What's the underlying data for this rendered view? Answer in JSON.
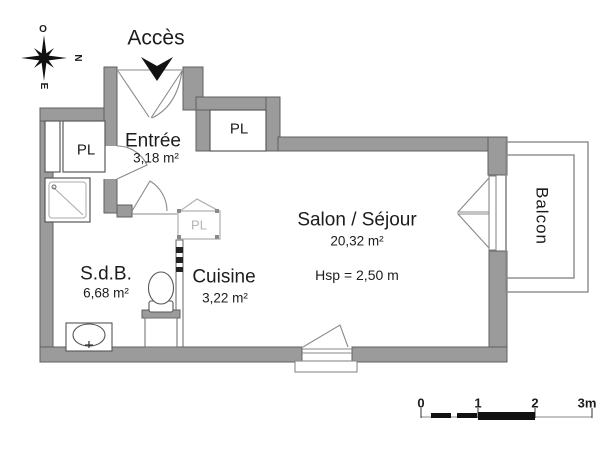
{
  "rooms": {
    "entree": {
      "name": "Entrée",
      "area": "3,18 m²"
    },
    "sdb": {
      "name": "S.d.B.",
      "area": "6,68 m²"
    },
    "cuisine": {
      "name": "Cuisine",
      "area": "3,22 m²"
    },
    "salon": {
      "name": "Salon / Séjour",
      "area": "20,32 m²",
      "ceiling": "Hsp = 2,50 m"
    },
    "balcon": {
      "name": "Balcon"
    }
  },
  "closets": {
    "sdb_pl": "PL",
    "entry_pl": "PL",
    "kitchen_pl": "PL"
  },
  "annotations": {
    "access": "Accès"
  },
  "compass": {
    "top": "O",
    "right": "N",
    "bottom": "E",
    "left": "S"
  },
  "scale_bar": {
    "ticks": [
      "0",
      "1",
      "2",
      "3m"
    ]
  },
  "colors": {
    "wall_fill": "#9b9b9b",
    "wall_edge": "#5f5f5f",
    "line": "#8a8a8a",
    "light_gray": "#b5b5b5",
    "ink": "#1c1c1c"
  }
}
